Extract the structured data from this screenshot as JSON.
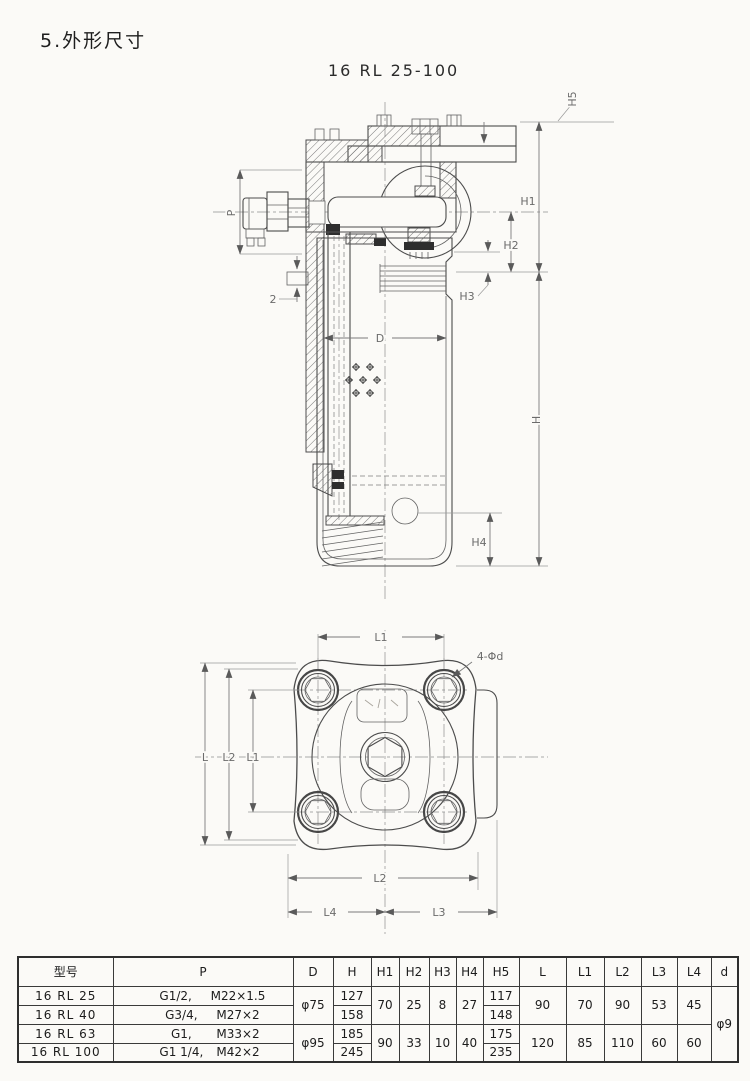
{
  "page": {
    "title": "5.外形尺寸",
    "subtitle": "16 RL 25-100"
  },
  "drawing": {
    "dim_labels": {
      "p": "P",
      "thickness": "2",
      "d": "D",
      "h": "H",
      "h1": "H1",
      "h2": "H2",
      "h3": "H3",
      "h4": "H4",
      "h5": "H5"
    },
    "bottom_labels": {
      "l": "L",
      "l1": "L1",
      "l2": "L2",
      "l3": "L3",
      "l4": "L4",
      "bolt_note": "4-Φd"
    }
  },
  "table": {
    "headers": {
      "model": "型号",
      "p": "P",
      "d": "D",
      "h": "H",
      "h1": "H1",
      "h2": "H2",
      "h3": "H3",
      "h4": "H4",
      "h5": "H5",
      "l": "L",
      "l1": "L1",
      "l2": "L2",
      "l3": "L3",
      "l4": "L4",
      "dd": "d"
    },
    "rows": [
      {
        "model": "16 RL 25",
        "p1": "G1/2,",
        "p2": "M22×1.5",
        "h": "127",
        "h5": "117"
      },
      {
        "model": "16 RL 40",
        "p1": "G3/4,",
        "p2": "M27×2",
        "h": "158",
        "h5": "148"
      },
      {
        "model": "16 RL 63",
        "p1": "G1,",
        "p2": "M33×2",
        "h": "185",
        "h5": "175"
      },
      {
        "model": "16 RL 100",
        "p1": "G1 1/4,",
        "p2": "M42×2",
        "h": "245",
        "h5": "235"
      }
    ],
    "groups": [
      {
        "d": "φ75",
        "h1": "70",
        "h2": "25",
        "h3": "8",
        "h4": "27",
        "l": "90",
        "l1": "70",
        "l2": "90",
        "l3": "53",
        "l4": "45"
      },
      {
        "d": "φ95",
        "h1": "90",
        "h2": "33",
        "h3": "10",
        "h4": "40",
        "l": "120",
        "l1": "85",
        "l2": "110",
        "l3": "60",
        "l4": "60"
      }
    ],
    "d_hole": "φ9"
  }
}
